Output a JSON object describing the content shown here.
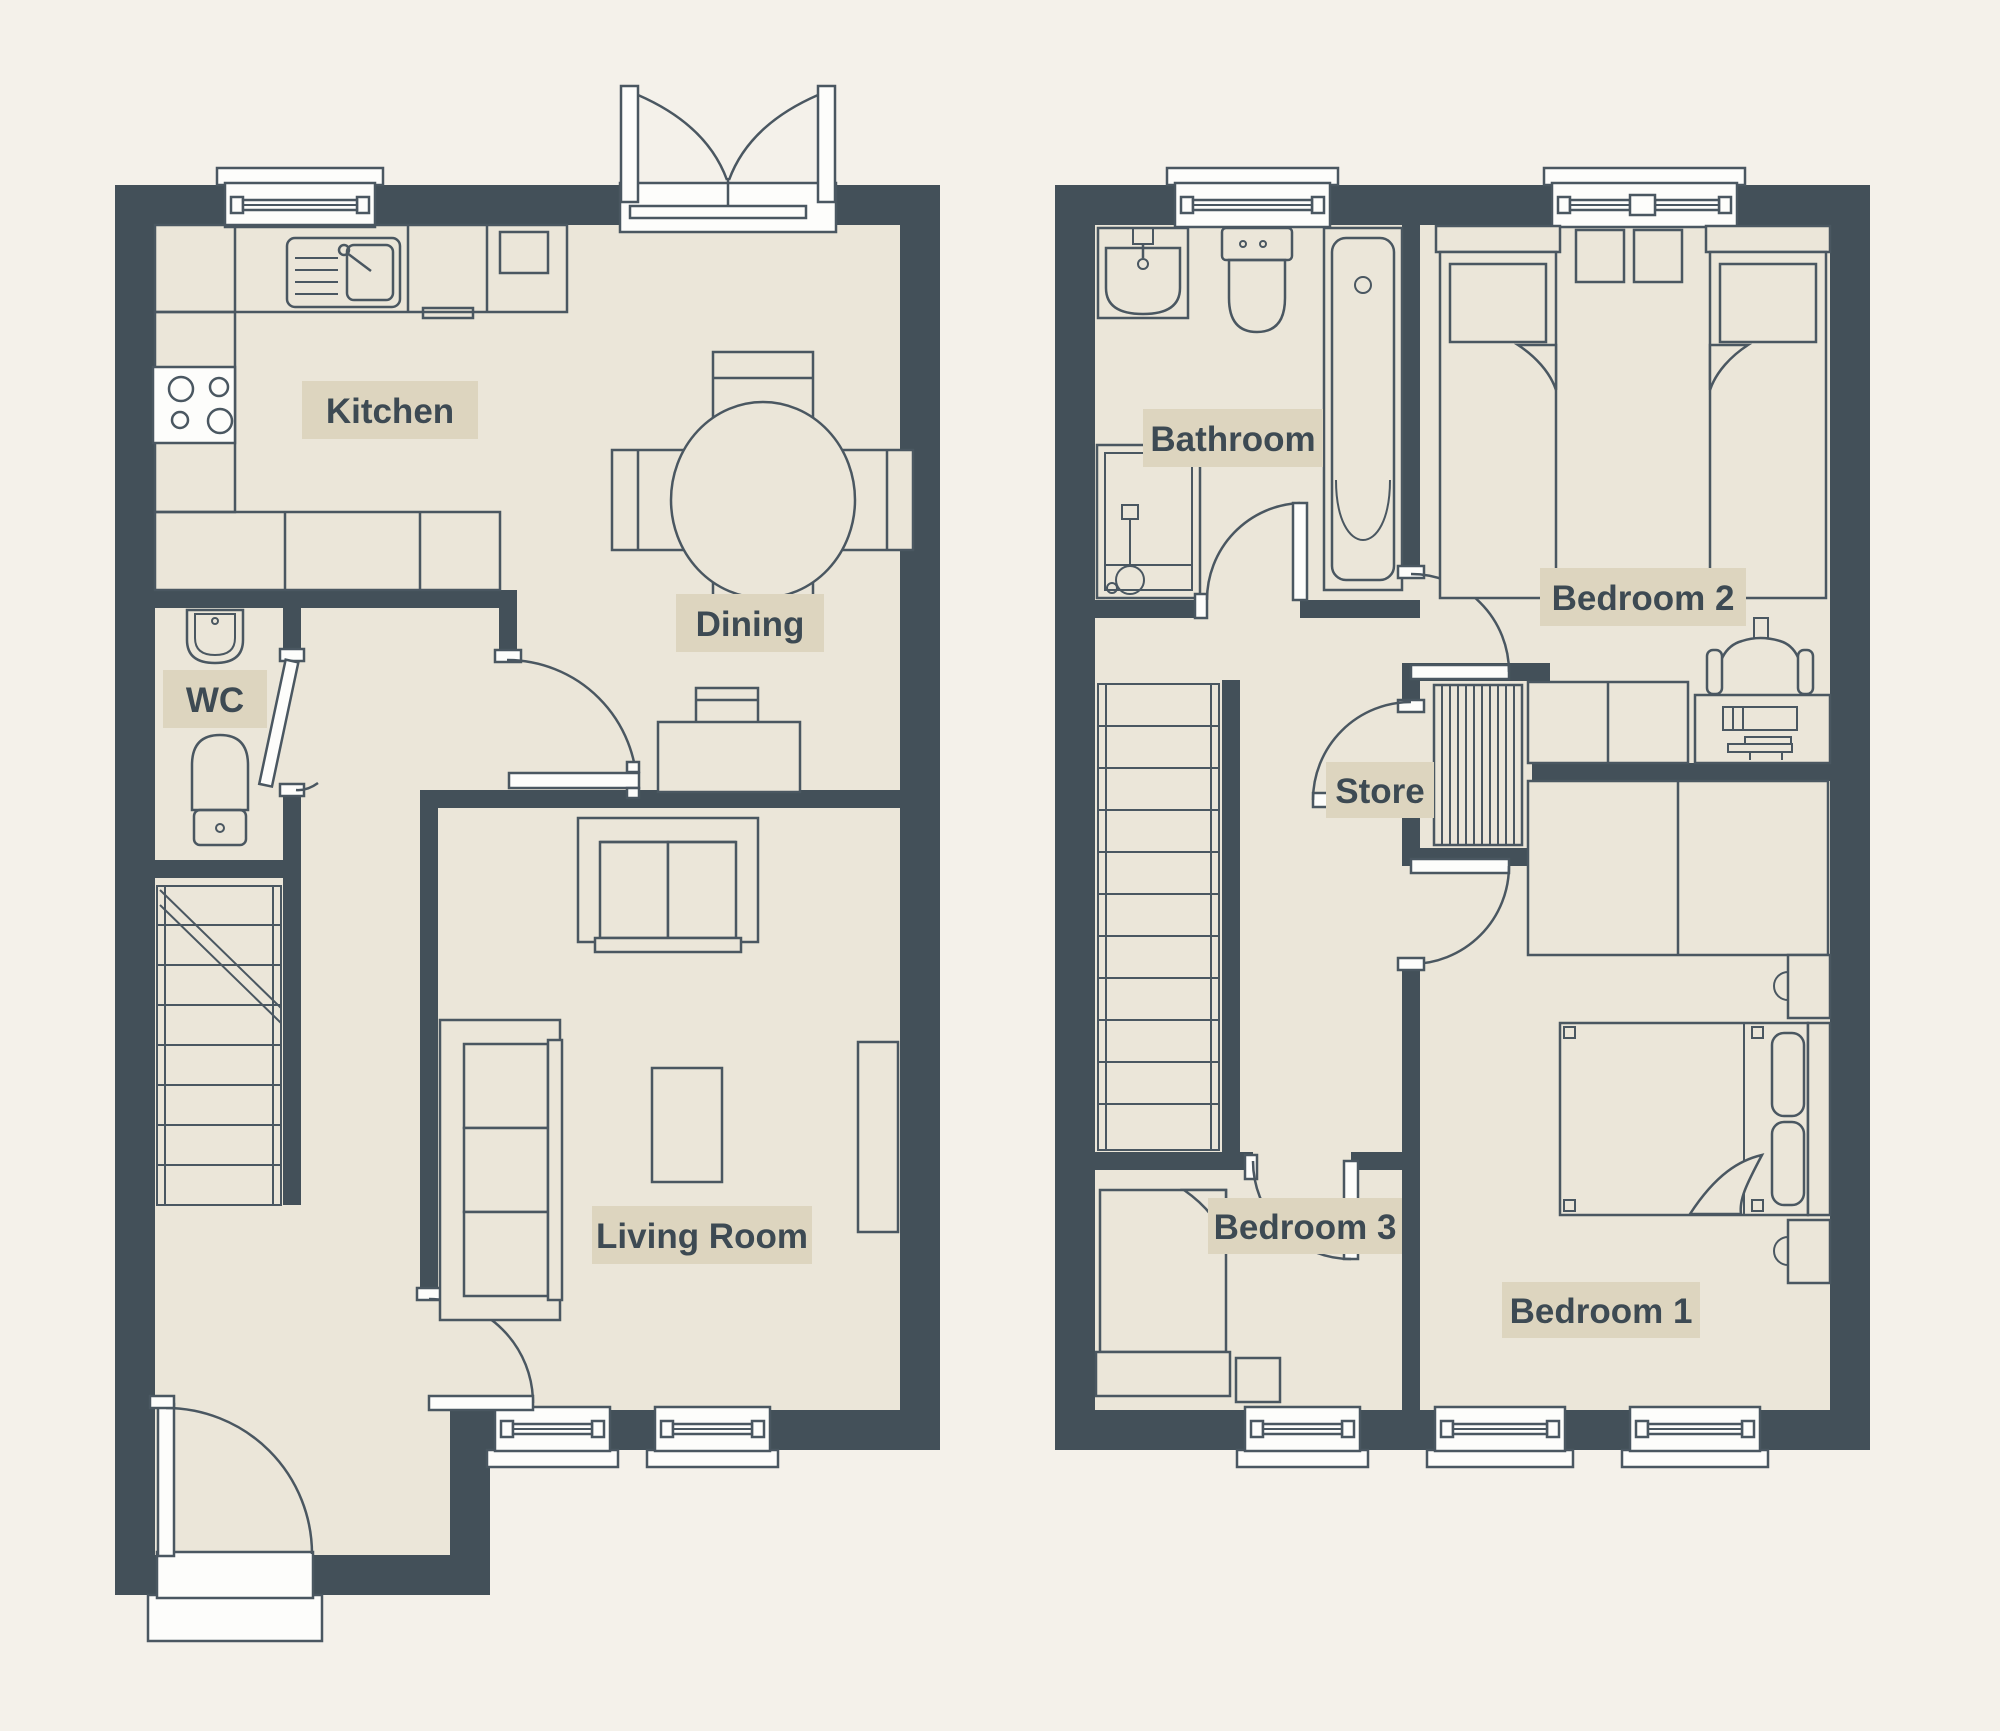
{
  "colors": {
    "bg": "#f4f1ea",
    "floor": "#ebe6d9",
    "wall": "#435059",
    "line": "#4a5761",
    "white": "#fdfdfb",
    "labelBg": "#ddd5bf",
    "ink": "#3d4a53"
  },
  "ground_floor": {
    "rooms": [
      {
        "label": "Kitchen"
      },
      {
        "label": "Dining"
      },
      {
        "label": "WC"
      },
      {
        "label": "Living Room"
      }
    ]
  },
  "first_floor": {
    "rooms": [
      {
        "label": "Bathroom"
      },
      {
        "label": "Bedroom 2"
      },
      {
        "label": "Store"
      },
      {
        "label": "Bedroom 3"
      },
      {
        "label": "Bedroom 1"
      }
    ]
  }
}
